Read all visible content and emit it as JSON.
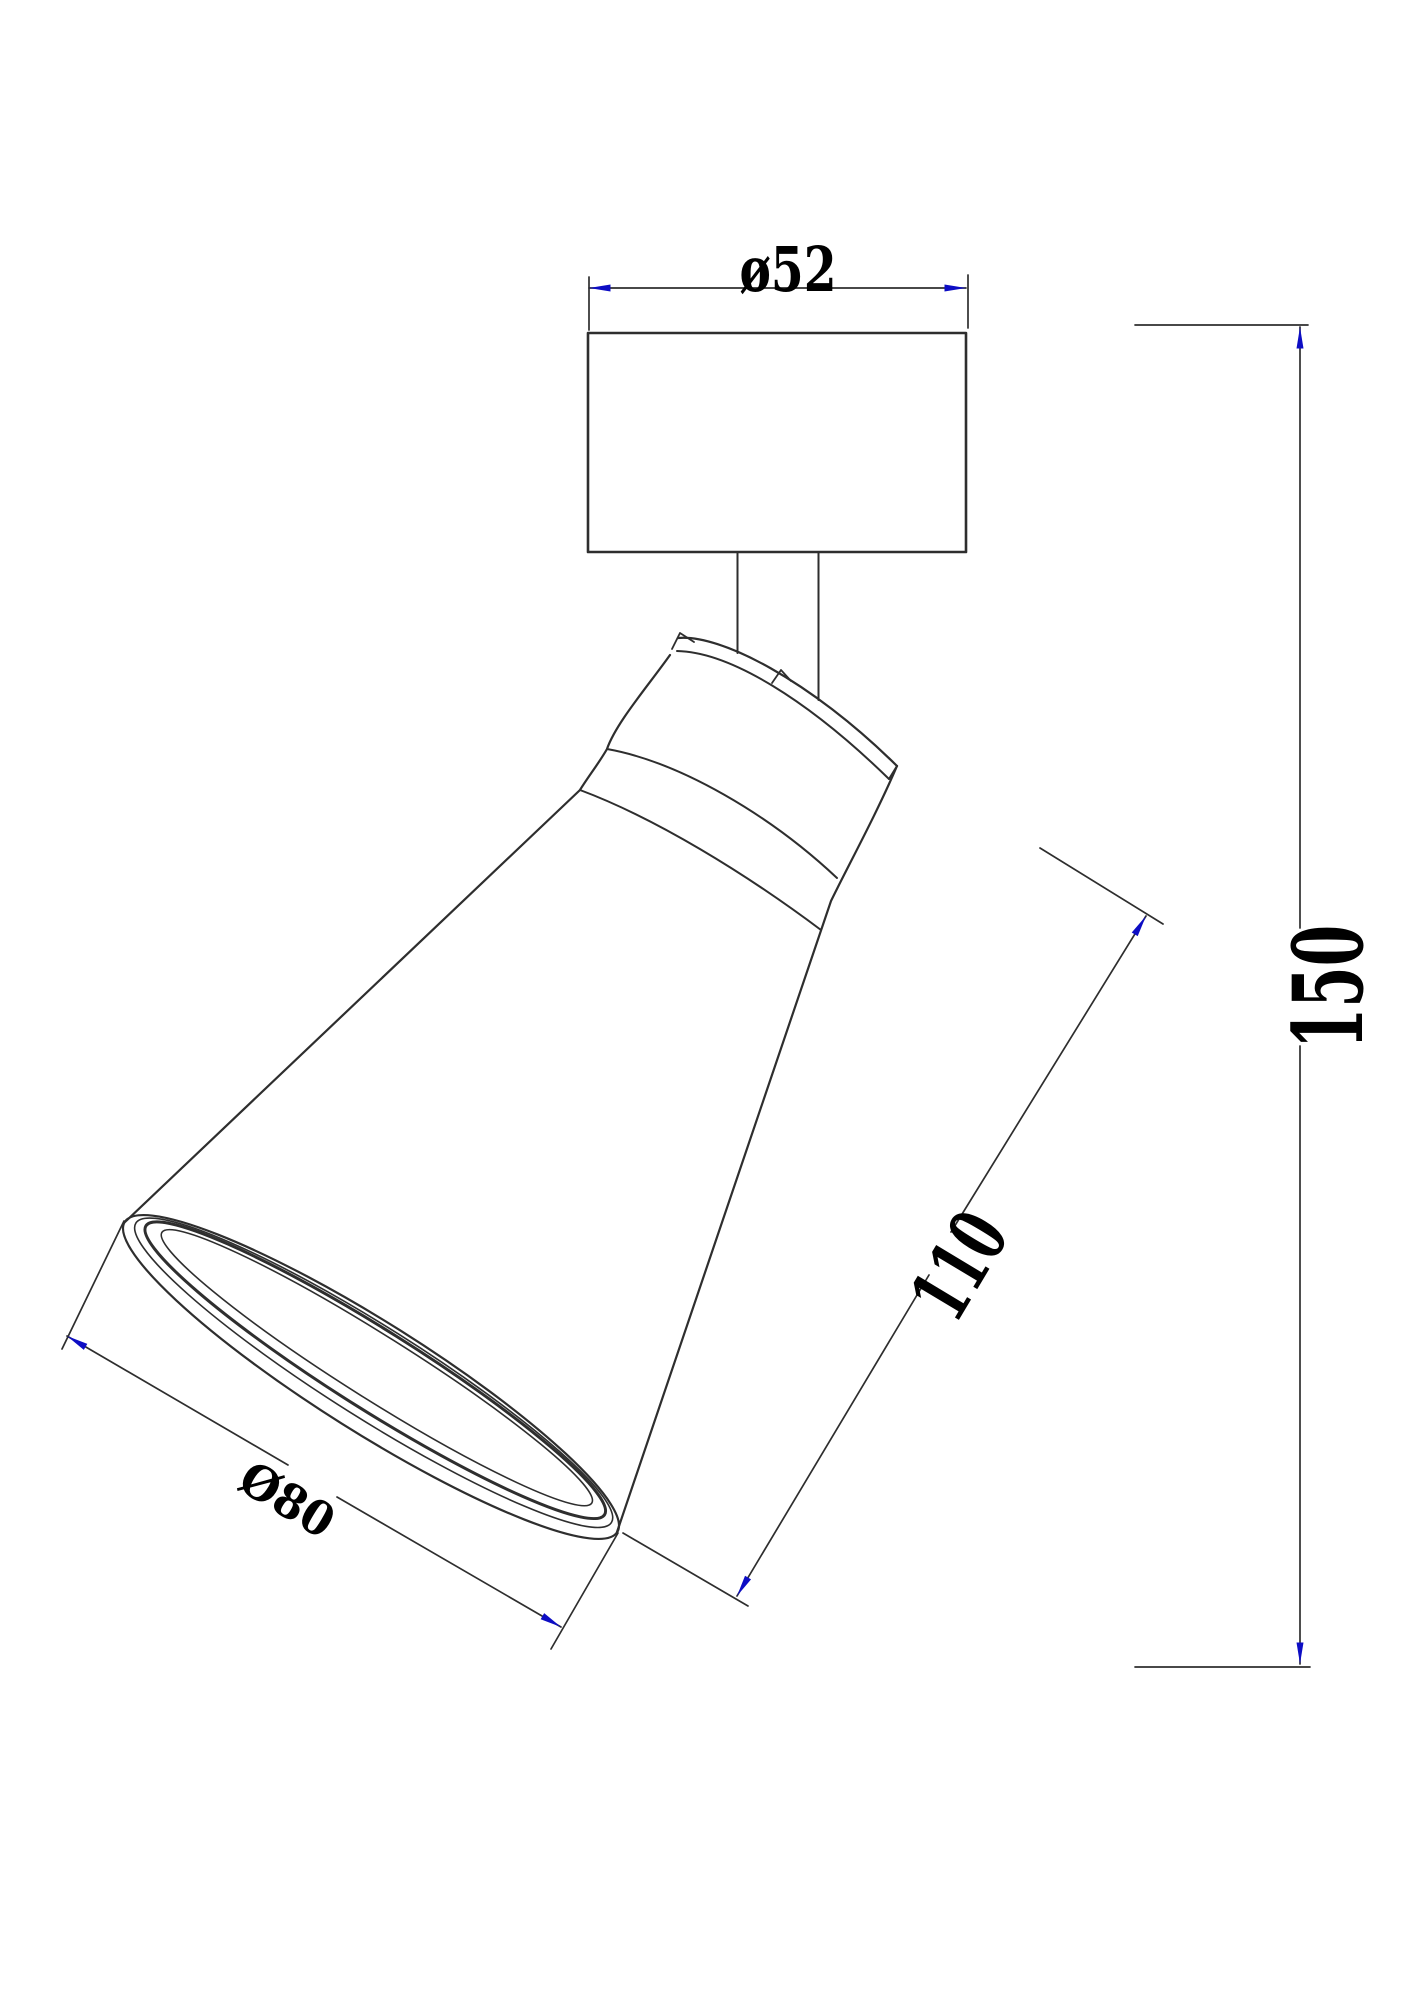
{
  "drawing": {
    "units": "mm",
    "view": "dimensioned outline drawing of an adjustable spot light fixture"
  },
  "dimensions": {
    "canopy_diameter": {
      "label": "ø52",
      "value": 52
    },
    "overall_height": {
      "label": "150",
      "value": 150
    },
    "body_length": {
      "label": "110",
      "value": 110
    },
    "shade_diameter": {
      "label": "Ø80",
      "value": 80
    }
  },
  "colors": {
    "line": "#2e2e2e",
    "arrow": "#0d0dc4",
    "text": "#000000",
    "background": "#ffffff"
  }
}
